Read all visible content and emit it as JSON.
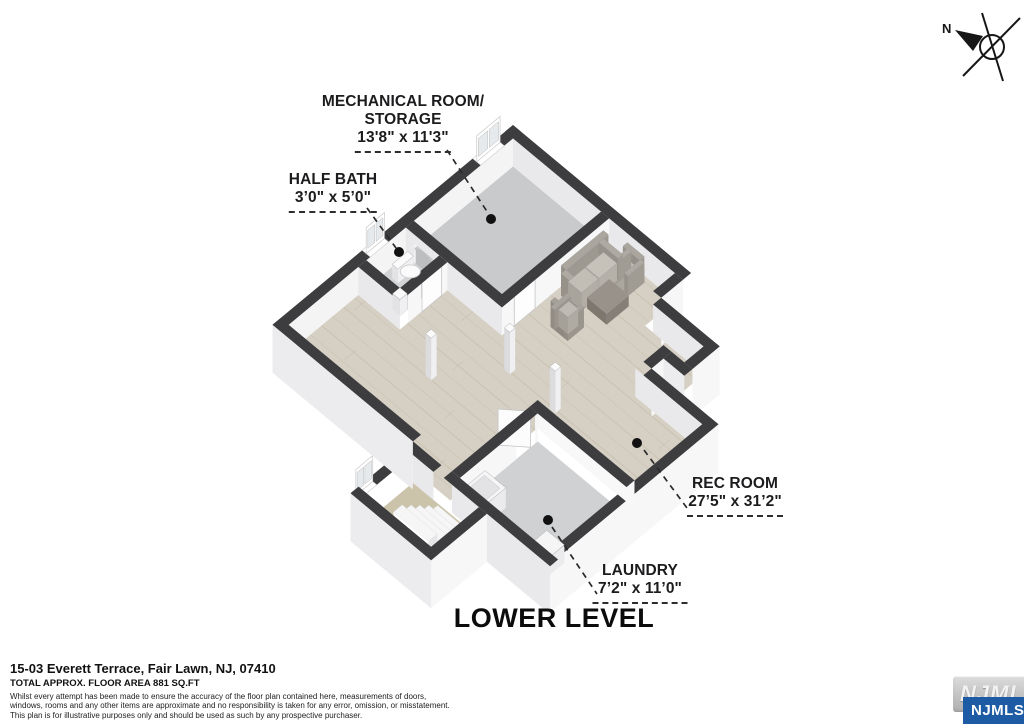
{
  "compass": {
    "north_label": "N"
  },
  "plan_title": "LOWER LEVEL",
  "rooms": [
    {
      "name": "MECHANICAL ROOM/",
      "name_line2": "STORAGE",
      "dims": "13'8\" x 11'3\""
    },
    {
      "name": "HALF BATH",
      "dims": "3ʼ0ʺ x 5ʼ0ʺ"
    },
    {
      "name": "REC ROOM",
      "dims": "27ʼ5ʺ x 31ʼ2ʺ"
    },
    {
      "name": "LAUNDRY",
      "dims": "7ʼ2ʺ x 11ʼ0ʺ"
    }
  ],
  "footer": {
    "address": "15-03 Everett Terrace, Fair Lawn, NJ, 07410",
    "floor_area": "TOTAL APPROX. FLOOR AREA 881 SQ.FT",
    "disclaimer": [
      "Whilst every attempt has been made to ensure the accuracy of the floor plan contained here, measurements of doors,",
      "windows, rooms and any other items are approximate and no responsibility is taken for any error, omission, or misstatement.",
      "This plan is for illustrative purposes only and should be used as such by any prospective purchaser."
    ]
  },
  "watermark": {
    "logo_text": "NJMLS",
    "badge_text": "NJMLS"
  },
  "colors": {
    "wall_top": "#3d3d3f",
    "wall_face_bright": "#f7f7f8",
    "wall_face_shade": "#e9e9eb",
    "wall_face_ext_shade": "#ececee",
    "floor_concrete": "#c9cacc",
    "floor_light": "#d3d4d6",
    "floor_laundry": "#d0d1d3",
    "floor_wood": "#d6d0c4",
    "plank_line": "#b3a790",
    "carpet": "#ccc4aa",
    "furniture_body": "#b2ada5",
    "furniture_cushion": "#c6c1b9",
    "table": "#98928a",
    "accent_blue": "#1d5ca5",
    "label_text": "#1c1c1e"
  }
}
